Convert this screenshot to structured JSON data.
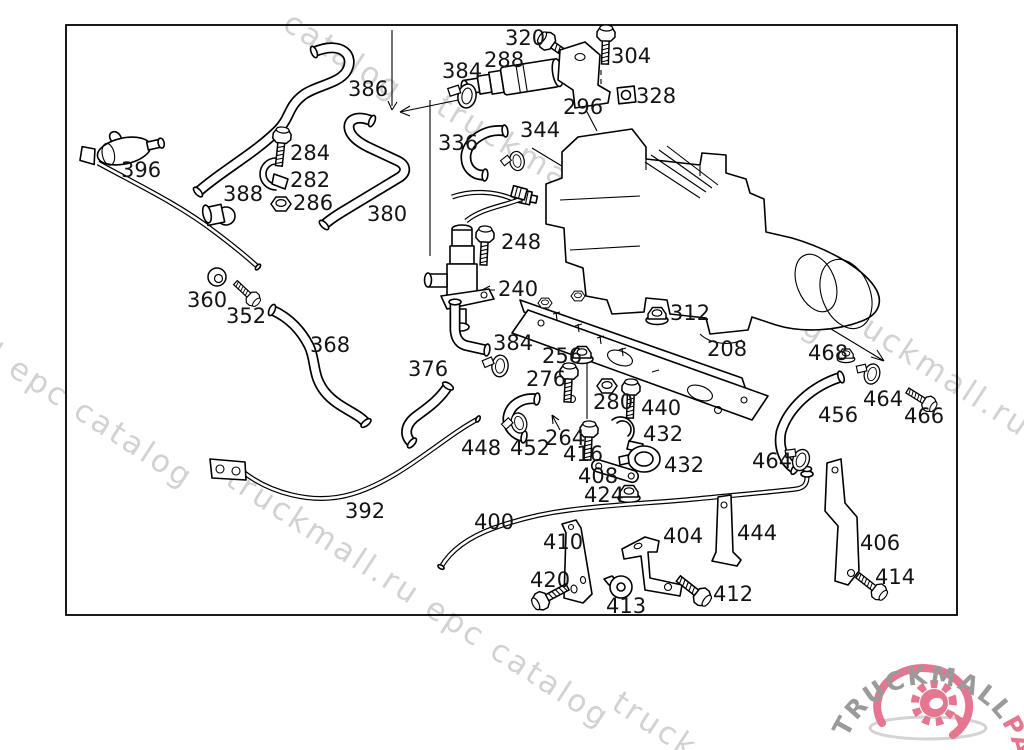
{
  "diagram": {
    "type": "parts-diagram",
    "watermark_text": "truckmall.ru epc catalog",
    "watermarks": [
      {
        "text": "catalog",
        "x": 281,
        "y": 28,
        "angle": 33
      },
      {
        "text": "truckmall.ru epc catalog",
        "x": 434,
        "y": 112,
        "angle": 31
      },
      {
        "text": "l epc catalog",
        "x": -14,
        "y": 360,
        "angle": 33
      },
      {
        "text": "truckmall.ru e",
        "x": 834,
        "y": 316,
        "angle": 33
      },
      {
        "text": "truckmall.ru epc catalog",
        "x": 224,
        "y": 484,
        "angle": 33
      },
      {
        "text": "truck",
        "x": 610,
        "y": 708,
        "angle": 33
      }
    ],
    "labels": [
      {
        "text": "320",
        "x": 505,
        "y": 45
      },
      {
        "text": "288",
        "x": 484,
        "y": 67
      },
      {
        "text": "384",
        "x": 442,
        "y": 78
      },
      {
        "text": "304",
        "x": 611,
        "y": 63
      },
      {
        "text": "328",
        "x": 636,
        "y": 103
      },
      {
        "text": "296",
        "x": 563,
        "y": 114
      },
      {
        "text": "344",
        "x": 520,
        "y": 137
      },
      {
        "text": "336",
        "x": 438,
        "y": 150
      },
      {
        "text": "386",
        "x": 348,
        "y": 96
      },
      {
        "text": "284",
        "x": 290,
        "y": 160
      },
      {
        "text": "282",
        "x": 290,
        "y": 187
      },
      {
        "text": "286",
        "x": 293,
        "y": 210
      },
      {
        "text": "388",
        "x": 223,
        "y": 201
      },
      {
        "text": "396",
        "x": 121,
        "y": 177
      },
      {
        "text": "380",
        "x": 367,
        "y": 221
      },
      {
        "text": "248",
        "x": 501,
        "y": 249
      },
      {
        "text": "240",
        "x": 498,
        "y": 296
      },
      {
        "text": "312",
        "x": 670,
        "y": 320
      },
      {
        "text": "208",
        "x": 707,
        "y": 356
      },
      {
        "text": "360",
        "x": 187,
        "y": 307
      },
      {
        "text": "352",
        "x": 226,
        "y": 323
      },
      {
        "text": "368",
        "x": 310,
        "y": 352
      },
      {
        "text": "376",
        "x": 408,
        "y": 376
      },
      {
        "text": "384",
        "x": 493,
        "y": 350
      },
      {
        "text": "256",
        "x": 542,
        "y": 363
      },
      {
        "text": "276",
        "x": 526,
        "y": 386
      },
      {
        "text": "280",
        "x": 593,
        "y": 409
      },
      {
        "text": "440",
        "x": 641,
        "y": 415
      },
      {
        "text": "432",
        "x": 643,
        "y": 441
      },
      {
        "text": "432",
        "x": 664,
        "y": 472
      },
      {
        "text": "448",
        "x": 461,
        "y": 455
      },
      {
        "text": "452",
        "x": 510,
        "y": 455
      },
      {
        "text": "264",
        "x": 545,
        "y": 445
      },
      {
        "text": "416",
        "x": 563,
        "y": 461
      },
      {
        "text": "408",
        "x": 578,
        "y": 483
      },
      {
        "text": "424",
        "x": 584,
        "y": 502
      },
      {
        "text": "400",
        "x": 474,
        "y": 529
      },
      {
        "text": "392",
        "x": 345,
        "y": 518
      },
      {
        "text": "410",
        "x": 543,
        "y": 549
      },
      {
        "text": "420",
        "x": 530,
        "y": 587
      },
      {
        "text": "404",
        "x": 663,
        "y": 543
      },
      {
        "text": "413",
        "x": 606,
        "y": 613
      },
      {
        "text": "412",
        "x": 713,
        "y": 601
      },
      {
        "text": "444",
        "x": 737,
        "y": 540
      },
      {
        "text": "406",
        "x": 860,
        "y": 550
      },
      {
        "text": "414",
        "x": 875,
        "y": 584
      },
      {
        "text": "468",
        "x": 808,
        "y": 360
      },
      {
        "text": "464",
        "x": 863,
        "y": 406
      },
      {
        "text": "466",
        "x": 904,
        "y": 423
      },
      {
        "text": "456",
        "x": 818,
        "y": 422
      },
      {
        "text": "464",
        "x": 752,
        "y": 468
      }
    ],
    "logo": {
      "brand_gray": "TRUCKMALL",
      "brand_pink": "PARTS",
      "gray_color": "#9a9a9a",
      "pink_color": "#e4768f"
    },
    "colors": {
      "line": "#000000",
      "background": "#ffffff",
      "watermark": "#c7c7c7"
    }
  }
}
